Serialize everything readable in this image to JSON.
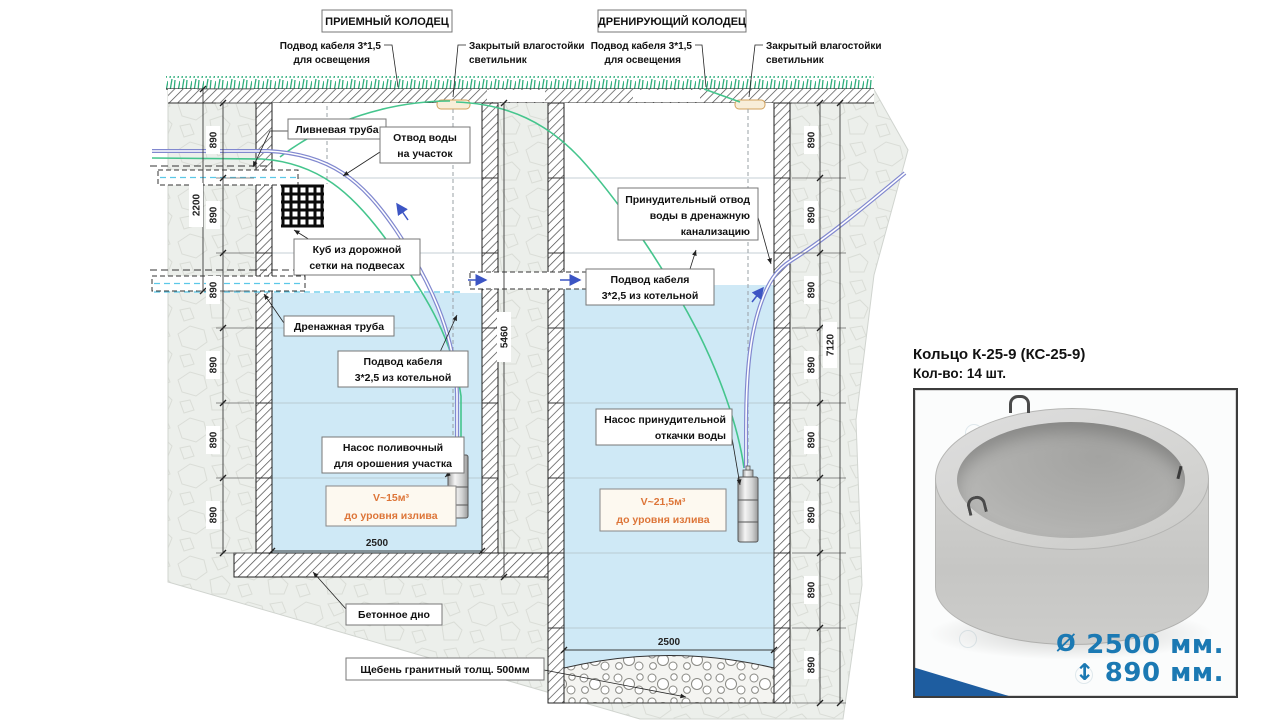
{
  "diagram": {
    "left_well_title": "ПРИЕМНЫЙ КОЛОДЕЦ",
    "right_well_title": "ДРЕНИРУЮЩИЙ КОЛОДЕЦ",
    "cable_lighting_line1": "Подвод кабеля 3*1,5",
    "cable_lighting_line2": "для освещения",
    "lamp_line1": "Закрытый влагостойки",
    "lamp_line2": "светильник",
    "storm_pipe": "Ливневая труба",
    "water_outlet_line1": "Отвод воды",
    "water_outlet_line2": "на участок",
    "mesh_cube_line1": "Куб из дорожной",
    "mesh_cube_line2": "сетки на подвесах",
    "drain_pipe": "Дренажная труба",
    "boiler_cable_line1": "Подвод кабеля",
    "boiler_cable_line2": "3*2,5 из котельной",
    "pump_left_line1": "Насос поливочный",
    "pump_left_line2": "для орошения участка",
    "volume_left_line1": "V~15м³",
    "volume_left_line2": "до уровня излива",
    "forced_outlet_line1": "Принудительный отвод",
    "forced_outlet_line2": "воды в дренажную",
    "forced_outlet_line3": "канализацию",
    "pump_right_line1": "Насос принудительной",
    "pump_right_line2": "откачки воды",
    "volume_right_line1": "V~21,5м³",
    "volume_right_line2": "до уровня излива",
    "concrete_bottom": "Бетонное дно",
    "gravel_bed": "Щебень гранитный толщ. 500мм",
    "dims": {
      "ring_height": "890",
      "upper_depth": "2200",
      "left_total_depth": "5460",
      "right_total_depth": "7120",
      "inner_width": "2500"
    }
  },
  "product": {
    "title": "Кольцо К-25-9 (КС-25-9)",
    "count": "Кол-во: 14 шт.",
    "diameter_symbol": "Ø",
    "diameter": "2500 мм.",
    "height_symbol": "↕",
    "height": "890 мм."
  },
  "colors": {
    "water": "#cfe9f6",
    "soil": "#ecefeb",
    "grass": "#2fae7c",
    "cable_green": "#45c58d",
    "pipe_purple": "#8188cf",
    "arrow_blue": "#3c55c4",
    "level_cyan": "#5bc8e8",
    "volume_orange": "#dd7538",
    "product_dim_blue": "#1b79b3"
  }
}
